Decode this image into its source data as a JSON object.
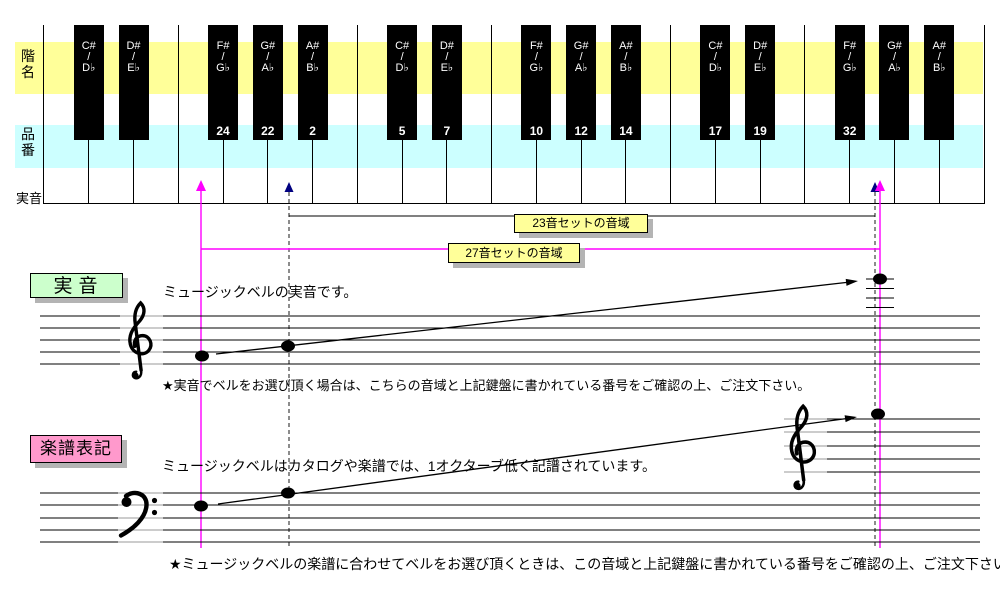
{
  "colors": {
    "band_yellow": "#FFFF99",
    "band_blue": "#CCFFFF",
    "badge_green": "#CCFFCC",
    "badge_pink": "#FF99CC",
    "pitch_red": "#CC0000",
    "line_magenta": "#FF00FF",
    "arrow_navy": "#000080",
    "range_box_yellow": "#FFFF99",
    "shadow_gray": "#B4B4B4"
  },
  "keyboard": {
    "row_labels": {
      "scale_name": "階名",
      "product_no": "品番",
      "actual_pitch": "実音"
    },
    "octave_marks": [
      {
        "index": 0,
        "text": "C4",
        "highlight": true
      },
      {
        "index": 7,
        "text": "C5",
        "highlight": false
      },
      {
        "index": 14,
        "text": "C6",
        "highlight": false
      }
    ],
    "white_keys": [
      {
        "note": "C",
        "num": ""
      },
      {
        "note": "D",
        "num": ""
      },
      {
        "note": "E",
        "num": ""
      },
      {
        "note": "F",
        "num": "25"
      },
      {
        "note": "G",
        "num": "23"
      },
      {
        "note": "A",
        "num": "1"
      },
      {
        "note": "B",
        "num": "3"
      },
      {
        "note": "C",
        "num": "4"
      },
      {
        "note": "D",
        "num": "6"
      },
      {
        "note": "E",
        "num": "8"
      },
      {
        "note": "F",
        "num": "9"
      },
      {
        "note": "G",
        "num": "11"
      },
      {
        "note": "A",
        "num": "13"
      },
      {
        "note": "B",
        "num": "15"
      },
      {
        "note": "C",
        "num": "16"
      },
      {
        "note": "D",
        "num": "18"
      },
      {
        "note": "E",
        "num": "20"
      },
      {
        "note": "F",
        "num": "21"
      },
      {
        "note": "G",
        "num": "33"
      },
      {
        "note": "A",
        "num": ""
      },
      {
        "note": "B",
        "num": ""
      }
    ],
    "black_keys": [
      {
        "boundary": 1,
        "sharp": "C#",
        "flat": "D♭",
        "num": ""
      },
      {
        "boundary": 2,
        "sharp": "D#",
        "flat": "E♭",
        "num": ""
      },
      {
        "boundary": 4,
        "sharp": "F#",
        "flat": "G♭",
        "num": "24"
      },
      {
        "boundary": 5,
        "sharp": "G#",
        "flat": "A♭",
        "num": "22"
      },
      {
        "boundary": 6,
        "sharp": "A#",
        "flat": "B♭",
        "num": "2"
      },
      {
        "boundary": 8,
        "sharp": "C#",
        "flat": "D♭",
        "num": "5"
      },
      {
        "boundary": 9,
        "sharp": "D#",
        "flat": "E♭",
        "num": "7"
      },
      {
        "boundary": 11,
        "sharp": "F#",
        "flat": "G♭",
        "num": "10"
      },
      {
        "boundary": 12,
        "sharp": "G#",
        "flat": "A♭",
        "num": "12"
      },
      {
        "boundary": 13,
        "sharp": "A#",
        "flat": "B♭",
        "num": "14"
      },
      {
        "boundary": 15,
        "sharp": "C#",
        "flat": "D♭",
        "num": "17"
      },
      {
        "boundary": 16,
        "sharp": "D#",
        "flat": "E♭",
        "num": "19"
      },
      {
        "boundary": 18,
        "sharp": "F#",
        "flat": "G♭",
        "num": "32"
      },
      {
        "boundary": 19,
        "sharp": "G#",
        "flat": "A♭",
        "num": ""
      },
      {
        "boundary": 20,
        "sharp": "A#",
        "flat": "B♭",
        "num": ""
      }
    ]
  },
  "ranges": {
    "set23": {
      "label": "23音セットの音域"
    },
    "set27": {
      "label": "27音セットの音域"
    }
  },
  "sections": {
    "actual": {
      "badge": "実音",
      "desc": "ミュージックベルの実音です。",
      "note": "★実音でベルをお選び頂く場合は、こちらの音域と上記鍵盤に書かれている番号をご確認の上、ご注文下さい。"
    },
    "notation": {
      "badge": "楽譜表記",
      "desc": "ミュージックベルはカタログや楽譜では、1オクターブ低く記譜されています。",
      "note": "★ミュージックベルの楽譜に合わせてベルをお選び頂くときは、この音域と上記鍵盤に書かれている番号をご確認の上、ご注文下さい。"
    }
  }
}
